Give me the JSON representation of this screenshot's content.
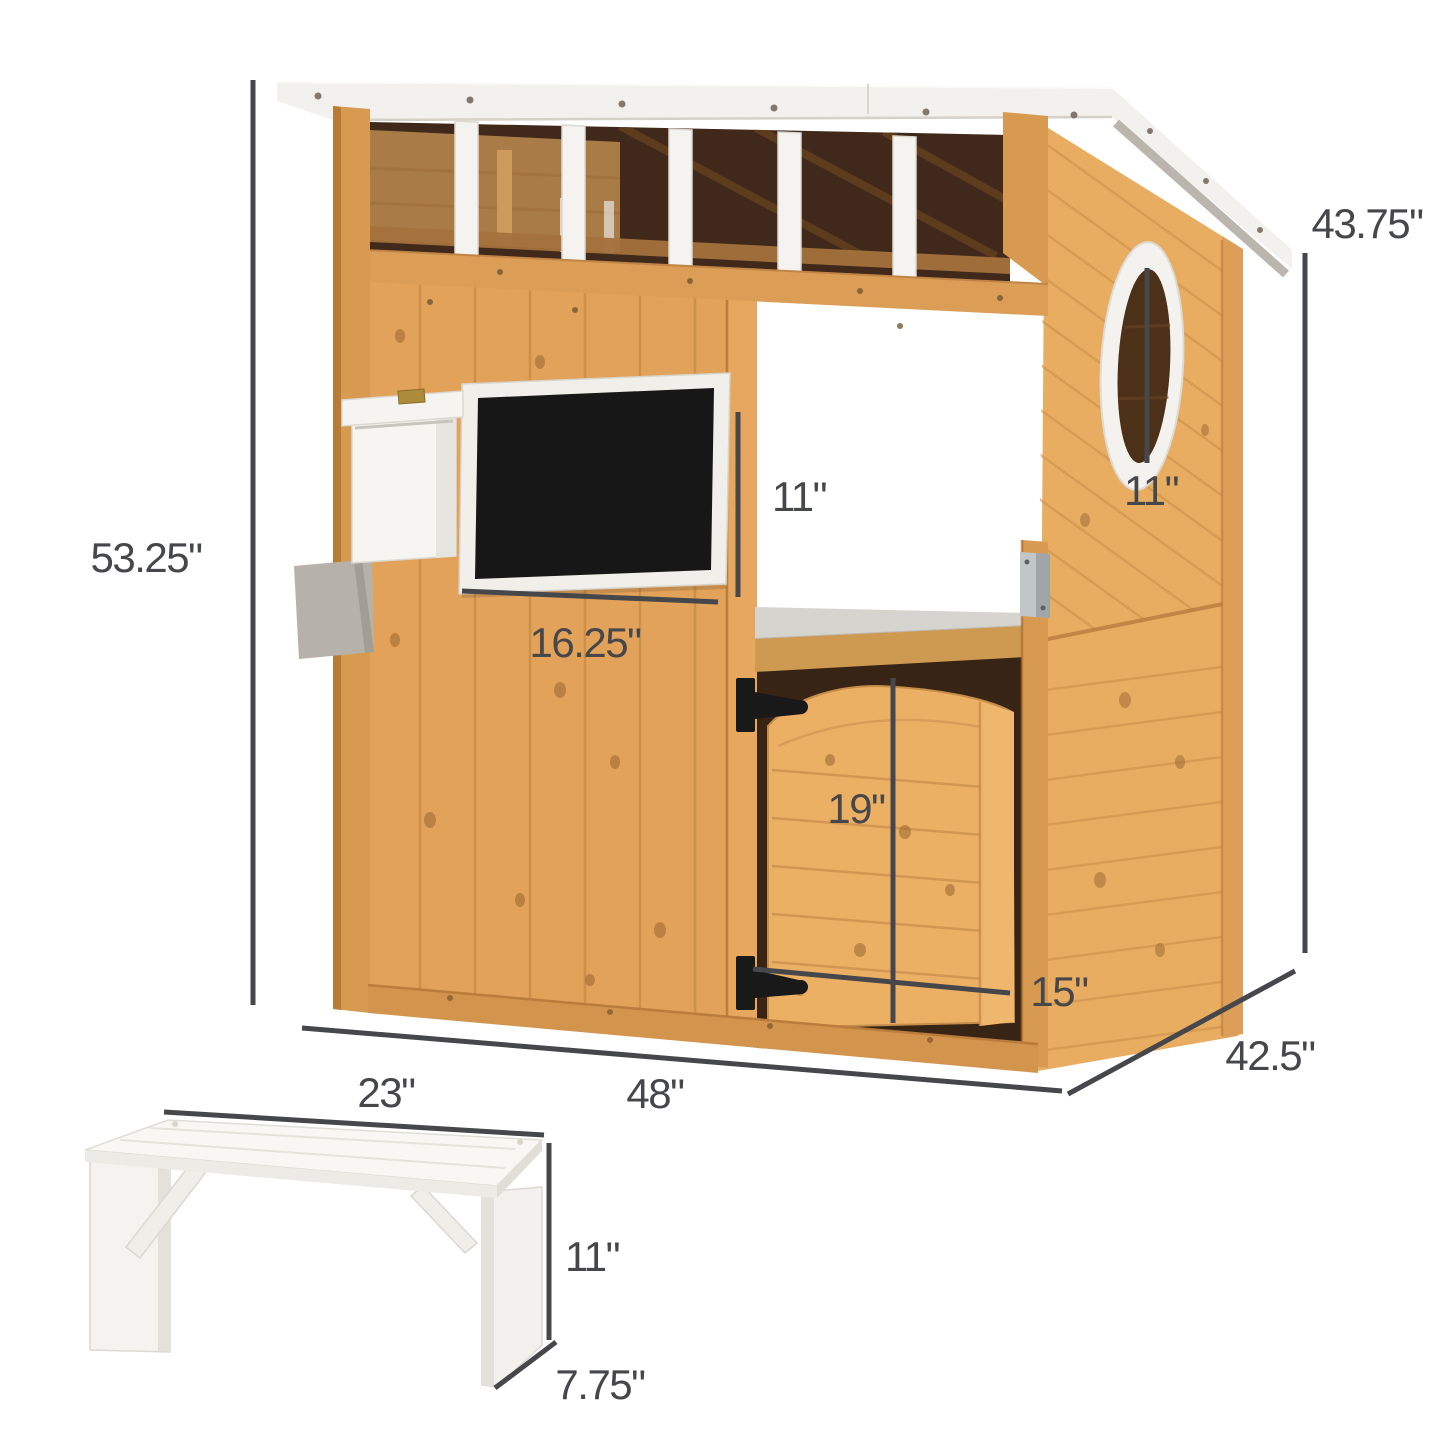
{
  "figure": {
    "kind": "product-dimension-diagram",
    "subject": "wooden outdoor kids playhouse with serving counter, chalkboard, mailbox, porthole window and white bench",
    "background": "#ffffff"
  },
  "colors": {
    "dimension": "#46474b",
    "wood": "#e2a259",
    "wood_light": "#ecb167",
    "wood_trim": "#d89950",
    "wood_dark_interior": "#40281a",
    "white_paint": "#f5f4f0",
    "roof_white": "#f2f1ed",
    "chalkboard_black": "#171717",
    "metal_plate": "#c3c6c8",
    "hinge_black": "#191919"
  },
  "playhouse": {
    "dimensions": {
      "overall_height": "53.25\"",
      "roof_side_height": "43.75\"",
      "serving_window_height": "11\"",
      "chalkboard_width": "16.25\"",
      "porthole_diameter": "11\"",
      "storage_door_height": "19\"",
      "storage_door_width": "15\"",
      "front_width": "48\"",
      "depth": "42.5\""
    }
  },
  "bench": {
    "dimensions": {
      "width": "23\"",
      "height": "11\"",
      "depth": "7.75\""
    }
  }
}
